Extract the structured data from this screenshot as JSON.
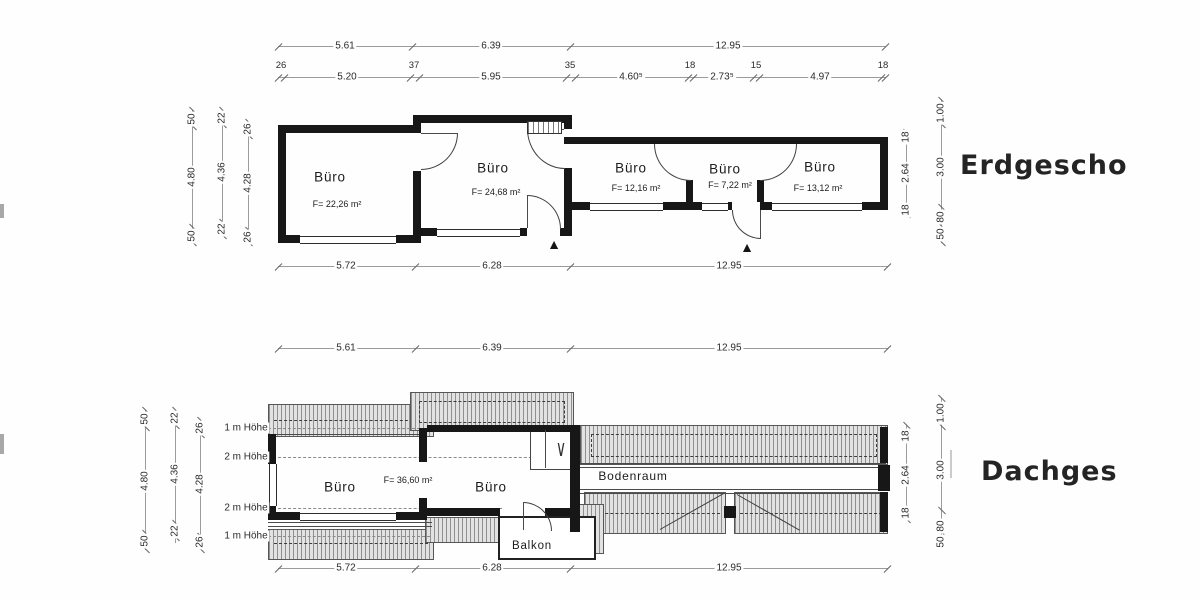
{
  "ground": {
    "title": "Erdgescho",
    "top1": [
      "5.61",
      "6.39",
      "12.95"
    ],
    "top2_small": [
      "26",
      "37",
      "35",
      "18",
      "15",
      "18"
    ],
    "top2_main": [
      "5.20",
      "5.95",
      "4.60⁵",
      "2.73⁵",
      "4.97"
    ],
    "left1": [
      "50",
      "4.80",
      "50"
    ],
    "left2": [
      "22",
      "4.36",
      "22"
    ],
    "left3": [
      "26",
      "4.28",
      "26"
    ],
    "right1": [
      "18",
      "2.64",
      "18"
    ],
    "right2": [
      "1.00",
      "3.00",
      "80",
      "50"
    ],
    "bottom": [
      "5.72",
      "6.28",
      "12.95"
    ],
    "rooms": [
      {
        "label": "Büro",
        "area": "F= 22,26 m²"
      },
      {
        "label": "Büro",
        "area": "F= 24,68 m²"
      },
      {
        "label": "Büro",
        "area": "F= 12,16 m²"
      },
      {
        "label": "Büro",
        "area": "F= 7,22 m²"
      },
      {
        "label": "Büro",
        "area": "F= 13,12 m²"
      }
    ]
  },
  "attic": {
    "title": "Dachges",
    "top1": [
      "5.61",
      "6.39",
      "12.95"
    ],
    "left1": [
      "50",
      "4.80",
      "50"
    ],
    "left2": [
      "22",
      "4.36",
      "22"
    ],
    "left3": [
      "26",
      "4.28",
      "26"
    ],
    "right1": [
      "18",
      "2.64",
      "18"
    ],
    "right2": [
      "1.00",
      "3.00",
      "80",
      "50"
    ],
    "bottom": [
      "5.72",
      "6.28",
      "12.95"
    ],
    "heights": [
      "1 m Höhe",
      "2 m Höhe",
      "2 m Höhe",
      "1 m Höhe"
    ],
    "rooms": [
      {
        "label": "Büro"
      },
      {
        "label": "Büro",
        "area": "F= 36,60 m²"
      },
      {
        "label": "Bodenraum"
      },
      {
        "label": "Balkon"
      }
    ]
  },
  "icons": {
    "stair_direction": "∨",
    "entrance_marker": "▲"
  }
}
